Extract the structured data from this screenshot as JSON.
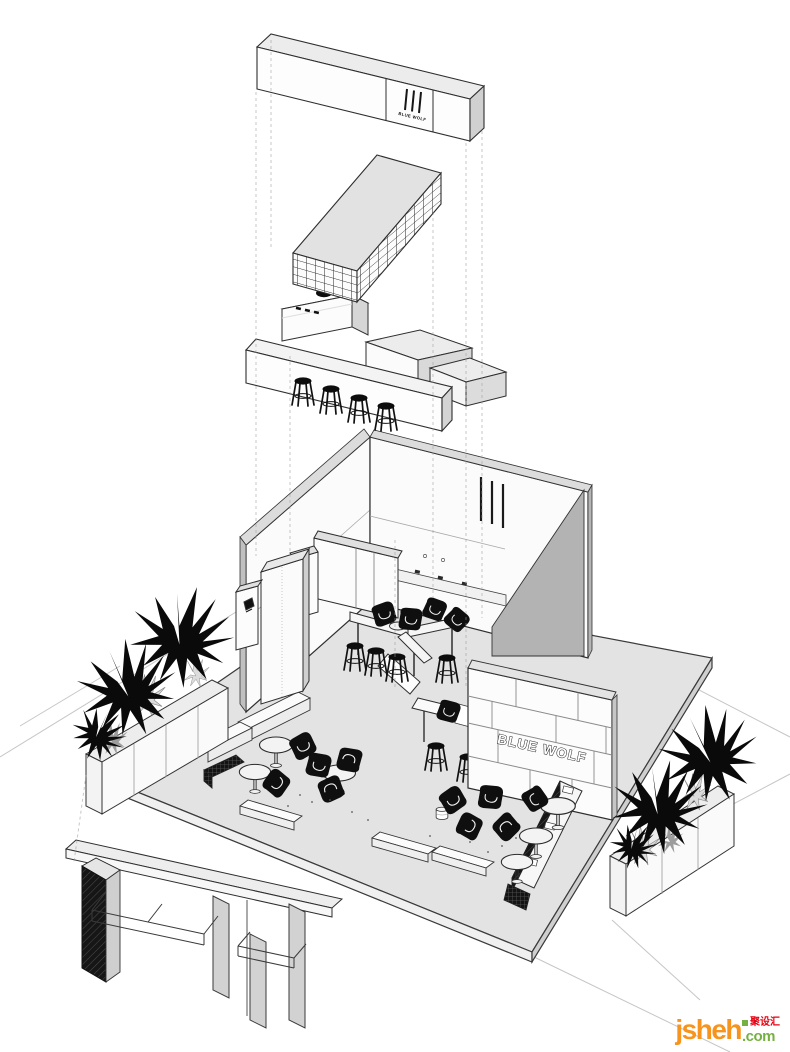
{
  "page": {
    "background": "#ffffff"
  },
  "scene": {
    "top_sign": {
      "label": "BLUE WOLF"
    },
    "feature_wall": {
      "label": "BLUE WOLF"
    }
  },
  "watermark": {
    "brand": "jsheh",
    "domain_suffix": ".com",
    "badge": "聚设汇"
  },
  "colors": {
    "outline": "#333333",
    "platform_gray": "#e3e3e3",
    "wall_shadow_gray": "#b3b3b3",
    "furniture_black": "#111111",
    "logo_orange": "#F7941D",
    "logo_green": "#76B043",
    "badge_red": "#E60012"
  }
}
